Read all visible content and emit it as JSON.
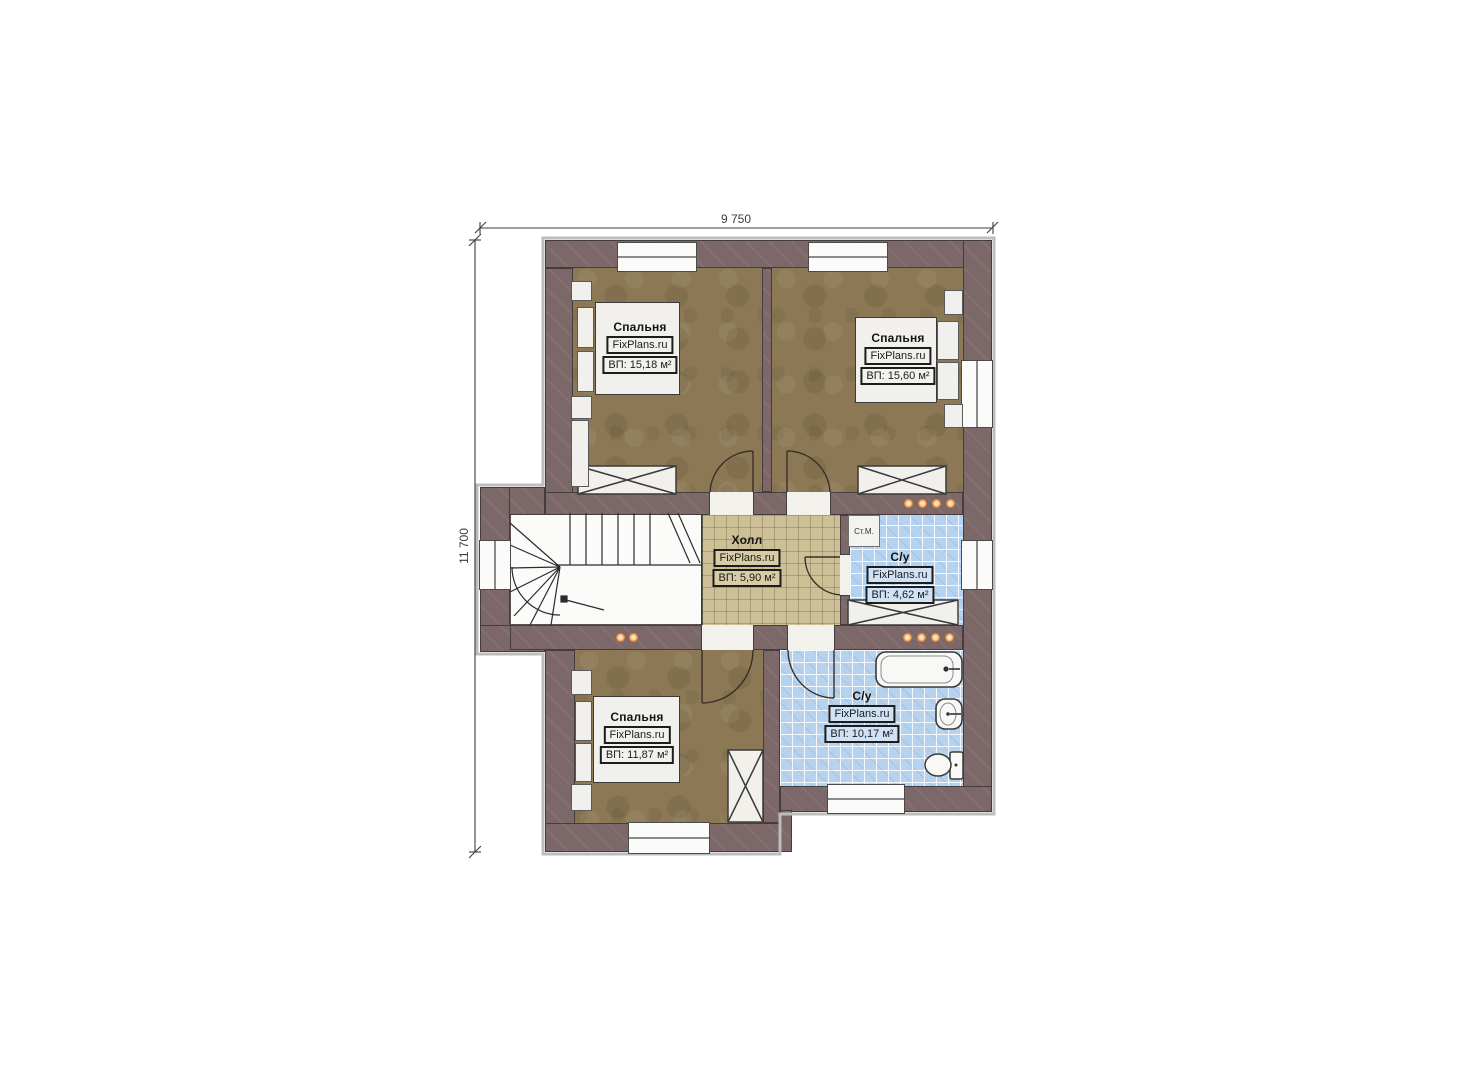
{
  "plan": {
    "dimensions": {
      "width_label": "9 750",
      "height_label": "11 700"
    },
    "rooms": {
      "bedroom_top_left": {
        "name": "Спальня",
        "brand": "FixPlans.ru",
        "area": "ВП: 15,18 м²"
      },
      "bedroom_top_right": {
        "name": "Спальня",
        "brand": "FixPlans.ru",
        "area": "ВП: 15,60 м²"
      },
      "bedroom_bottom": {
        "name": "Спальня",
        "brand": "FixPlans.ru",
        "area": "ВП: 11,87 м²"
      },
      "hall": {
        "name": "Холл",
        "brand": "FixPlans.ru",
        "area": "ВП: 5,90 м²"
      },
      "bathroom_small": {
        "name": "С/у",
        "brand": "FixPlans.ru",
        "area": "ВП: 4,62 м²"
      },
      "bathroom_large": {
        "name": "С/у",
        "brand": "FixPlans.ru",
        "area": "ВП: 10,17 м²"
      }
    },
    "appliances": {
      "washing_machine_label": "Ст.М."
    },
    "colors": {
      "wall": "#7D6869",
      "bedroom_floor": "#8C7855",
      "hall_floor": "#CDC096",
      "bathroom_floor": "#B5D2EF",
      "stair_floor": "#FBFBFA",
      "spotlight": "#E8802B"
    }
  }
}
